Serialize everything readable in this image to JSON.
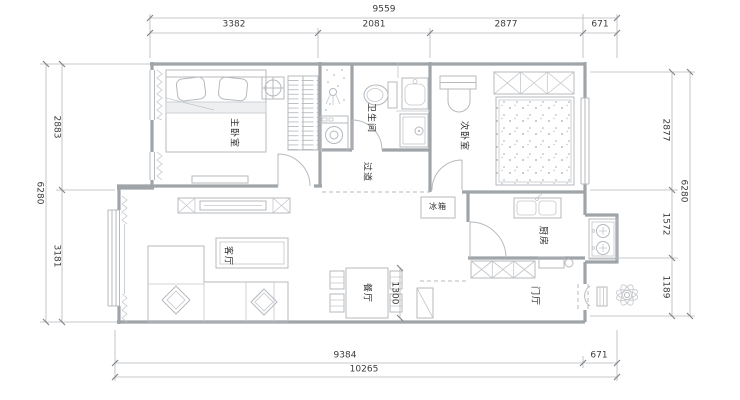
{
  "floor_plan": {
    "dimensions_mm": {
      "top": {
        "total": "9559",
        "segments": [
          "3382",
          "2081",
          "2877",
          "671"
        ]
      },
      "bottom": {
        "total": "10265",
        "segments": [
          "9384",
          "671"
        ]
      },
      "left": {
        "total": "6280",
        "segments": [
          "2883",
          "3181"
        ]
      },
      "right": {
        "total": "6280",
        "segments": [
          "2877",
          "1572",
          "1189"
        ]
      },
      "dining_width": "1300"
    },
    "rooms": {
      "master_bedroom": "主卧室",
      "second_bedroom": "次卧室",
      "bathroom": "卫生间",
      "hallway": "过道",
      "kitchen": "厨房",
      "living_room": "客厅",
      "dining_room": "餐厅",
      "entry_hall": "门厅"
    },
    "appliances": {
      "fridge": "冰箱"
    },
    "colors": {
      "background": "#ffffff",
      "wall_line": "#9fa4a9",
      "fixture_line": "#b6b9be",
      "dimension_line": "#b4b7bb",
      "text": "#3b3b3b"
    }
  }
}
